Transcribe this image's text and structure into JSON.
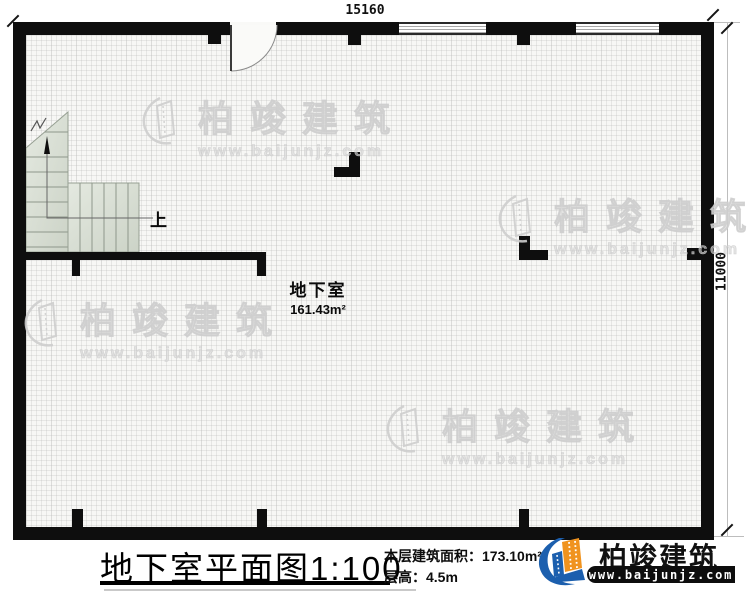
{
  "dims": {
    "width": "15160",
    "height": "11000"
  },
  "plan": {
    "room_name": "地下室",
    "room_area": "161.43m²",
    "up_label": "上"
  },
  "title_block": {
    "title": "地下室平面图",
    "scale": "1:100",
    "area_label": "本层建筑面积：",
    "area_value": "173.10m²",
    "floor_height_label": "层高：",
    "floor_height_value": "4.5m"
  },
  "brand": {
    "name": "柏竣建筑",
    "url": "www.baijunjz.com"
  },
  "watermark": {
    "name": "柏竣建筑",
    "url": "www.baijunjz.com"
  },
  "colors": {
    "wall": "#0e0e0e",
    "stair_fill": "#dde3d9",
    "brand_blue": "#1c5fae",
    "brand_orange": "#f0931f",
    "watermark": "#dcdcdc"
  }
}
